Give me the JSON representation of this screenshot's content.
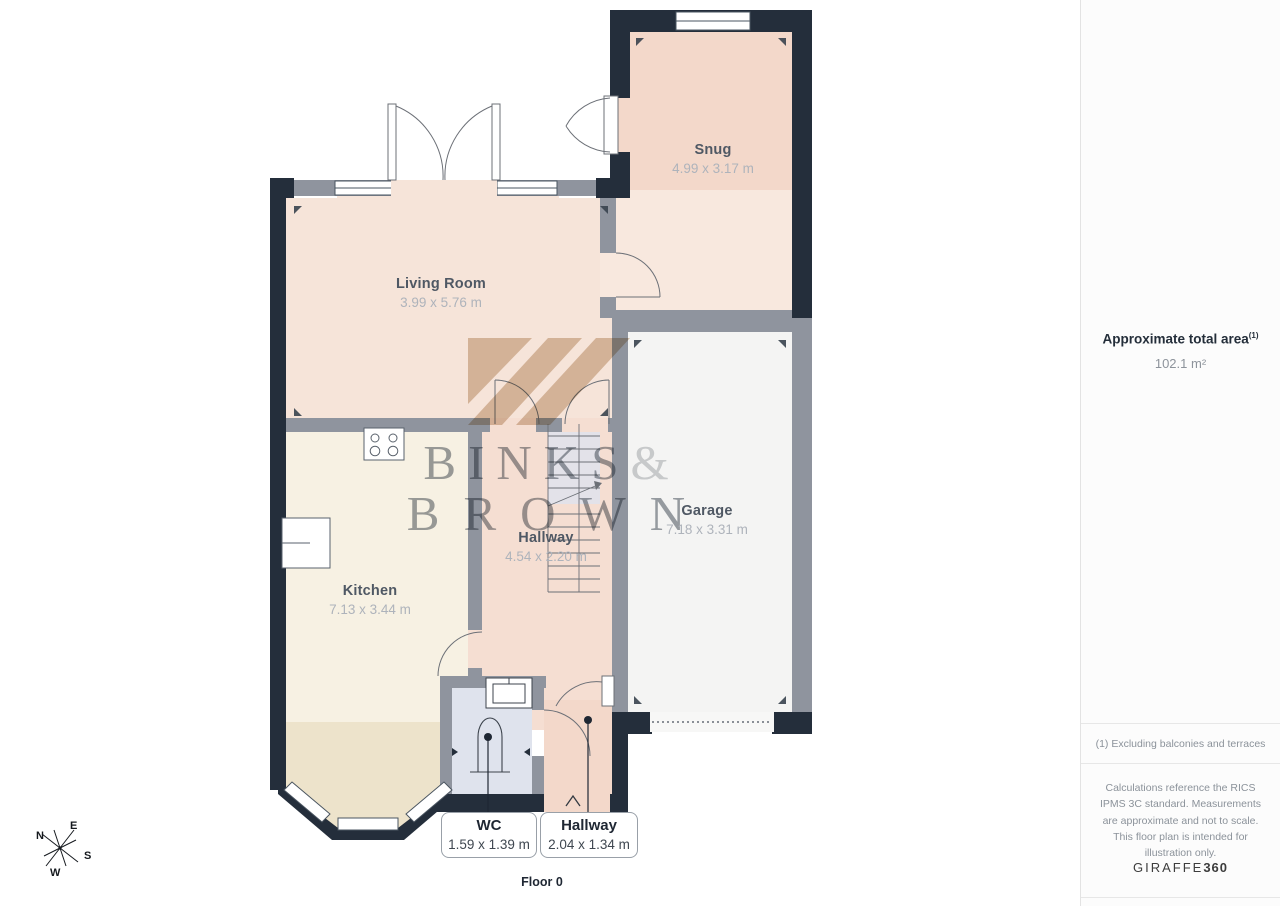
{
  "floor_plan": {
    "floor_label": "Floor 0",
    "rooms": [
      {
        "id": "snug",
        "name": "Snug",
        "dims": "4.99 x 3.17 m"
      },
      {
        "id": "living-room",
        "name": "Living Room",
        "dims": "3.99 x 5.76 m"
      },
      {
        "id": "garage",
        "name": "Garage",
        "dims": "7.18 x 3.31 m"
      },
      {
        "id": "hallway",
        "name": "Hallway",
        "dims": "4.54 x 2.20 m"
      },
      {
        "id": "kitchen",
        "name": "Kitchen",
        "dims": "7.13 x 3.44 m"
      }
    ],
    "callouts": [
      {
        "id": "wc",
        "name": "WC",
        "dims": "1.59 x 1.39 m"
      },
      {
        "id": "hallway-entry",
        "name": "Hallway",
        "dims": "2.04 x 1.34 m"
      }
    ],
    "compass": {
      "north": "N",
      "east": "E",
      "south": "S",
      "west": "W"
    }
  },
  "watermark": {
    "word1": "BINKS",
    "ampersand": "&",
    "word2": "BROWN"
  },
  "sidebar": {
    "area_title": "Approximate total area",
    "area_footnote_marker": "(1)",
    "area_value": "102.1 m²",
    "footnote": "(1) Excluding balconies and terraces",
    "disclaimer": "Calculations reference the RICS IPMS 3C standard. Measurements are approximate and not to scale. This floor plan is intended for illustration only.",
    "brand_name": "GIRAFFE",
    "brand_suffix": "360"
  },
  "colors": {
    "wall_exterior": "#242e3b",
    "wall_interior": "#8f949e",
    "room_snug": "#f3d8ca",
    "room_living": "#f6e4d9",
    "room_hallway": "#f5ded2",
    "room_kitchen": "#f7f1e3",
    "room_garage": "#f4f4f3",
    "room_wc": "#dfe3ed",
    "bay_window": "#ede3cb",
    "accent_text": "#1f2733"
  }
}
